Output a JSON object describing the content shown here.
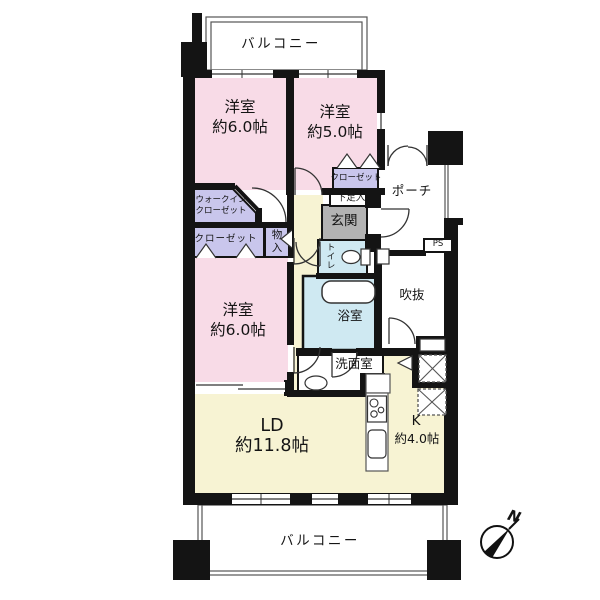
{
  "colors": {
    "wall": "#141414",
    "bedroom_pink": "#f8dbe7",
    "closet_lavender": "#c9c6ec",
    "floor_cream": "#f7f3d3",
    "wet_area_blue": "#cfe9f2",
    "entrance_gray": "#b3b3b3",
    "outline_thin": "#555555"
  },
  "floor_plan": {
    "balcony_top": {
      "label": "バルコニー"
    },
    "bedroom_top_left": {
      "name": "洋室",
      "size": "約6.0帖"
    },
    "bedroom_top_right": {
      "name": "洋室",
      "size": "約5.0帖"
    },
    "walk_in_closet": {
      "line1": "ウォークイン",
      "line2": "クローゼット"
    },
    "closet_top_right": {
      "label": "クローゼット"
    },
    "shoe_cabinet": {
      "label": "下足入"
    },
    "entrance": {
      "label": "玄関"
    },
    "porch": {
      "label": "ポーチ"
    },
    "pipe_space": {
      "label": "PS"
    },
    "closet_left": {
      "label": "クローゼット"
    },
    "storage": {
      "char1": "物",
      "char2": "入"
    },
    "toilet": {
      "char1": "ト",
      "char2": "イ",
      "char3": "レ"
    },
    "void": {
      "label": "吹抜"
    },
    "bedroom_left": {
      "name": "洋室",
      "size": "約6.0帖"
    },
    "bathroom": {
      "label": "浴室"
    },
    "washroom": {
      "label": "洗面室"
    },
    "living_dining": {
      "name": "LD",
      "size": "約11.8帖"
    },
    "kitchen": {
      "name": "K",
      "size": "約4.0帖"
    },
    "balcony_bottom": {
      "label": "バルコニー"
    },
    "compass": {
      "north_label": "N"
    }
  }
}
